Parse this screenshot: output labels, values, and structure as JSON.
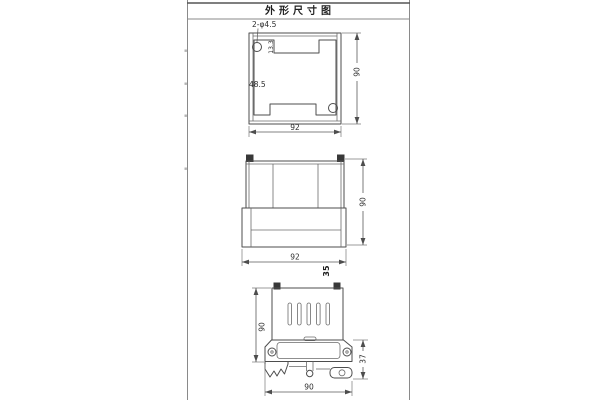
{
  "title": "外形尺寸图",
  "accent_line_color": "#4d4d4d",
  "views": {
    "top": {
      "hole_callout": "2-φ4.5",
      "notch_depth": "13.3",
      "cavity_width": "48.5",
      "height": "90",
      "width": "92"
    },
    "front": {
      "height": "90",
      "width": "92",
      "depth": "35"
    },
    "side": {
      "height": "90",
      "rail_offset": "37",
      "width": "90"
    }
  }
}
